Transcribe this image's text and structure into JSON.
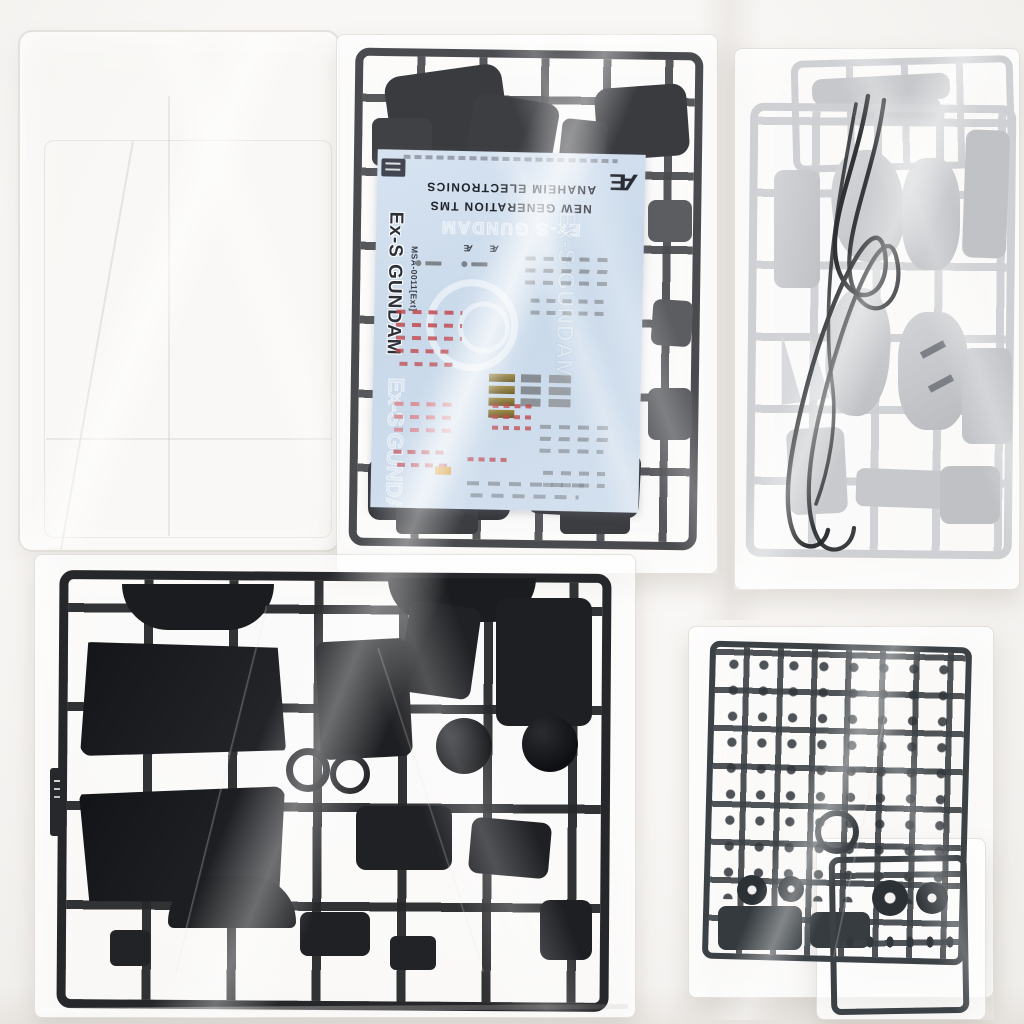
{
  "scene": {
    "type": "product-photo",
    "subject": "Gundam Ex-S model kit box contents: plastic runners sealed in poly bags, clear parts tray, black wire leads and water-slide decal sheet on white background",
    "background_color": "#f4f2ef"
  },
  "decal_sheet": {
    "sheet_color": "#cddcec",
    "title": "Ex-S GUNDAM",
    "model_code": "MSA-0011[Ext]",
    "brand_line1": "ANAHEIM ELECTRONICS",
    "brand_line2": "NEW GENERATION TMS",
    "logo_mark": "Æ",
    "watermark": "Ex-S GUNDAM",
    "mark_colors": {
      "red": "#c24a50",
      "pink": "#d98b92",
      "gold": "#8f7d3c",
      "orange": "#d79a35",
      "gray": "#8d9298"
    }
  },
  "runners": {
    "top_center_color": "#4a4b4f",
    "top_right_color": "#ced0d3",
    "bottom_left_color": "#1d1e21",
    "bottom_right_color": "#3c4145",
    "wire_color": "#26292b",
    "clear_tray_color": "#f6f1ee"
  }
}
